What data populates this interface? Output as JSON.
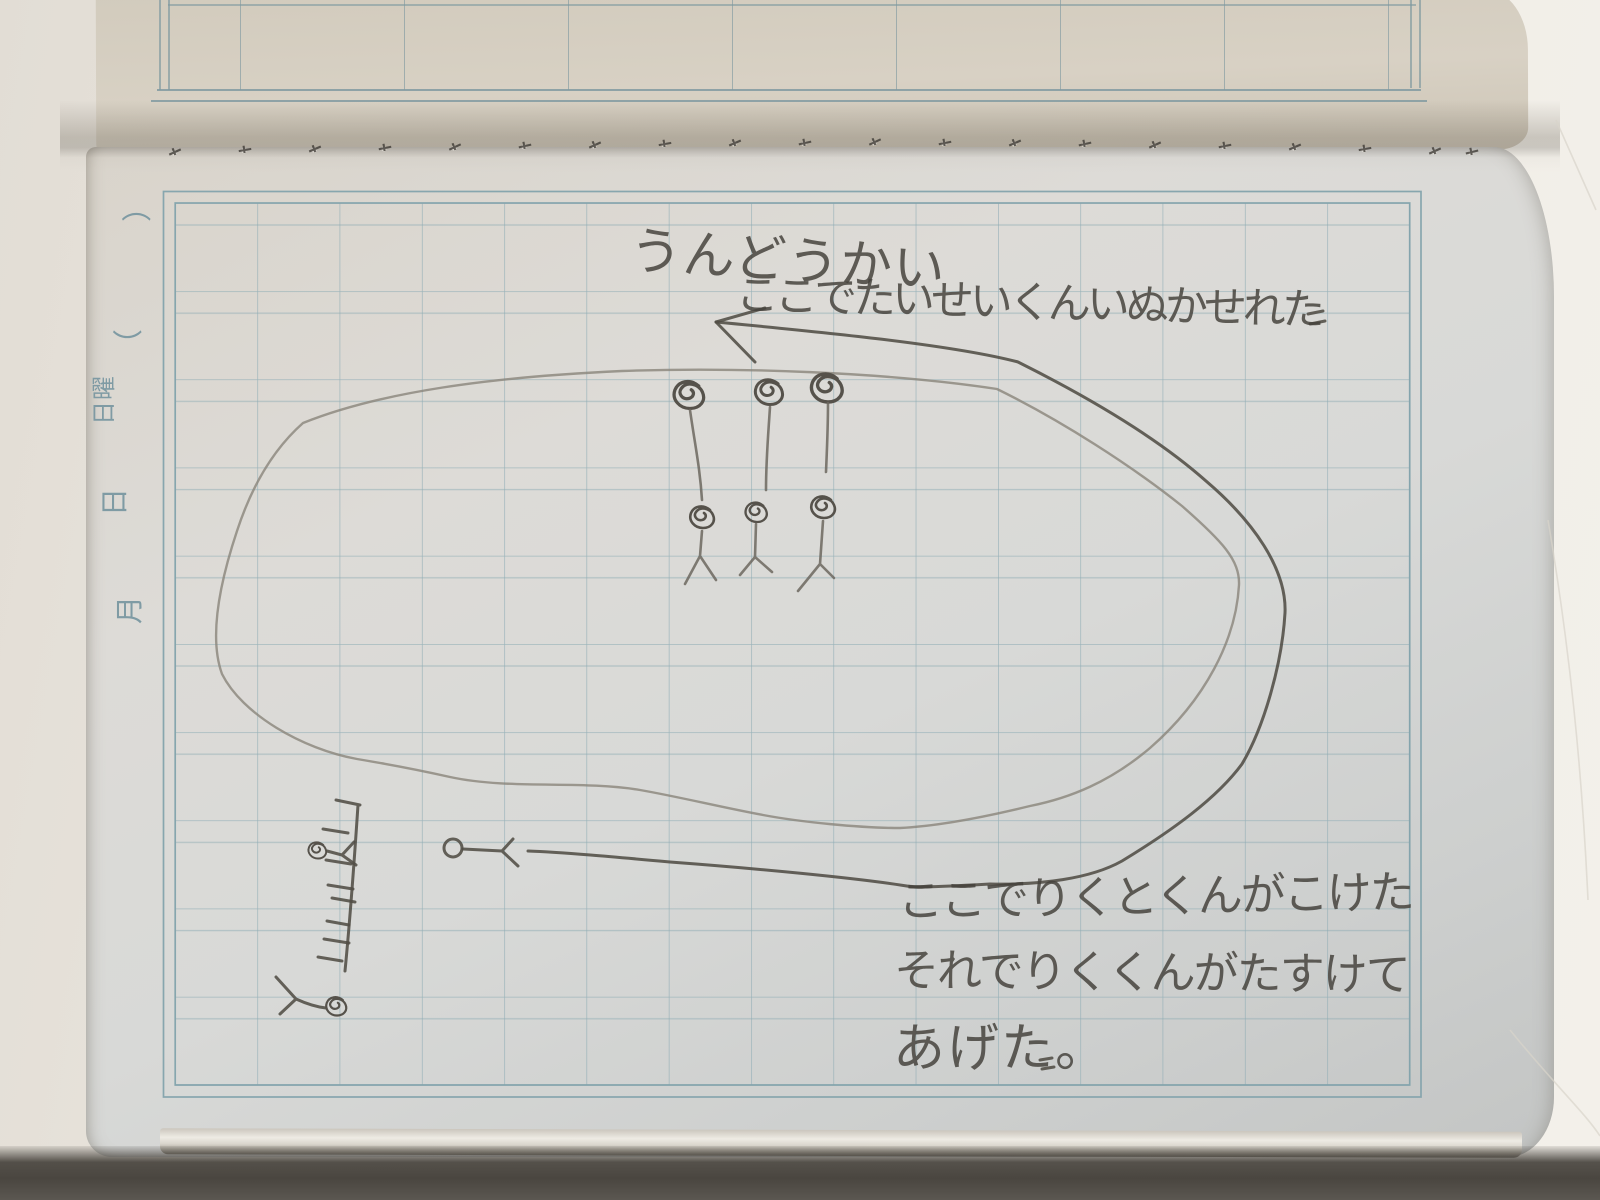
{
  "scene": {
    "type": "photograph of an open grid-ruled notebook",
    "subject": "child's pencil drawing of a sports-day oval track with stick figures, balloons and handwritten notes"
  },
  "handwriting": {
    "title": "うんどうかい",
    "caption_top": "ここでたいせいくんいぬかせれた",
    "caption_bottom_line1": "ここでりくとくんがこけた",
    "caption_bottom_line2": "それでりくくんがたすけて",
    "caption_bottom_line3": "あげた。"
  },
  "margin_labels": {
    "paren_close": "）",
    "paren_open": "（",
    "weekday_char1": "曜",
    "weekday_char2": "日",
    "day": "日",
    "month": "月"
  },
  "drawing": {
    "track": "large hand-drawn oval track with double outline",
    "arrow": "pencil arrow pointing left at top of track",
    "balloon_count": 3,
    "runner_figure_count": 3,
    "fallen_figure_count": 3,
    "start_line": "vertical line with tick marks"
  },
  "colors": {
    "paper_top": "#d4cdc0",
    "paper_main": "#dbd9d5",
    "grid_line": "#8dacb4",
    "margin_ink": "#7b98a2",
    "pencil_dark": "#514d46",
    "pencil_light": "#8a847a",
    "desk": "#efece6",
    "shadow": "#4a4640"
  }
}
